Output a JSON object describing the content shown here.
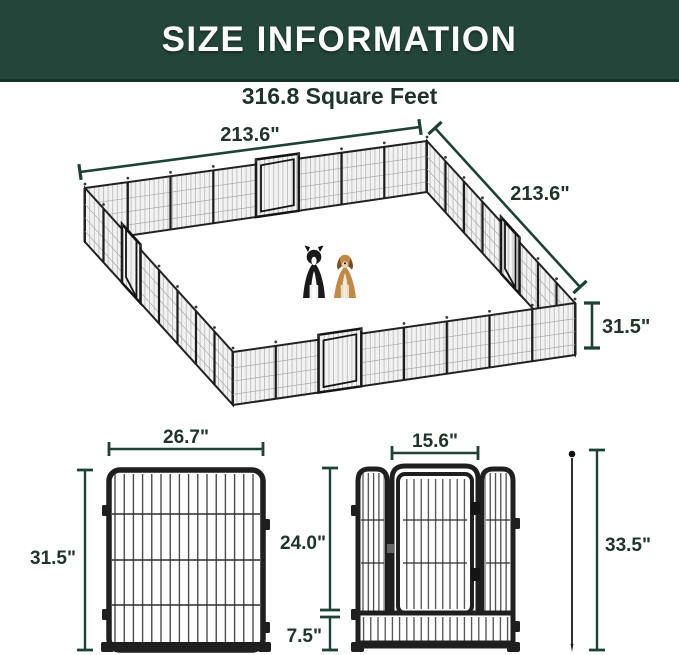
{
  "header": {
    "title": "SIZE INFORMATION"
  },
  "subtitle": "316.8 Square Feet",
  "pen": {
    "width_label": "213.6\"",
    "depth_label": "213.6\"",
    "height_label": "31.5\""
  },
  "panel": {
    "width_label": "26.7\"",
    "height_label": "31.5\""
  },
  "door_panel": {
    "door_width_label": "15.6\"",
    "door_height_label": "24.0\"",
    "bottom_height_label": "7.5\"",
    "stake_height_label": "33.5\""
  },
  "colors": {
    "header_bg": "#24453a",
    "header_text": "#fdfdfd",
    "dimension_color": "#21352c",
    "frame_color": "#1f1f1f",
    "mesh_fill": "#f2f2f2"
  }
}
